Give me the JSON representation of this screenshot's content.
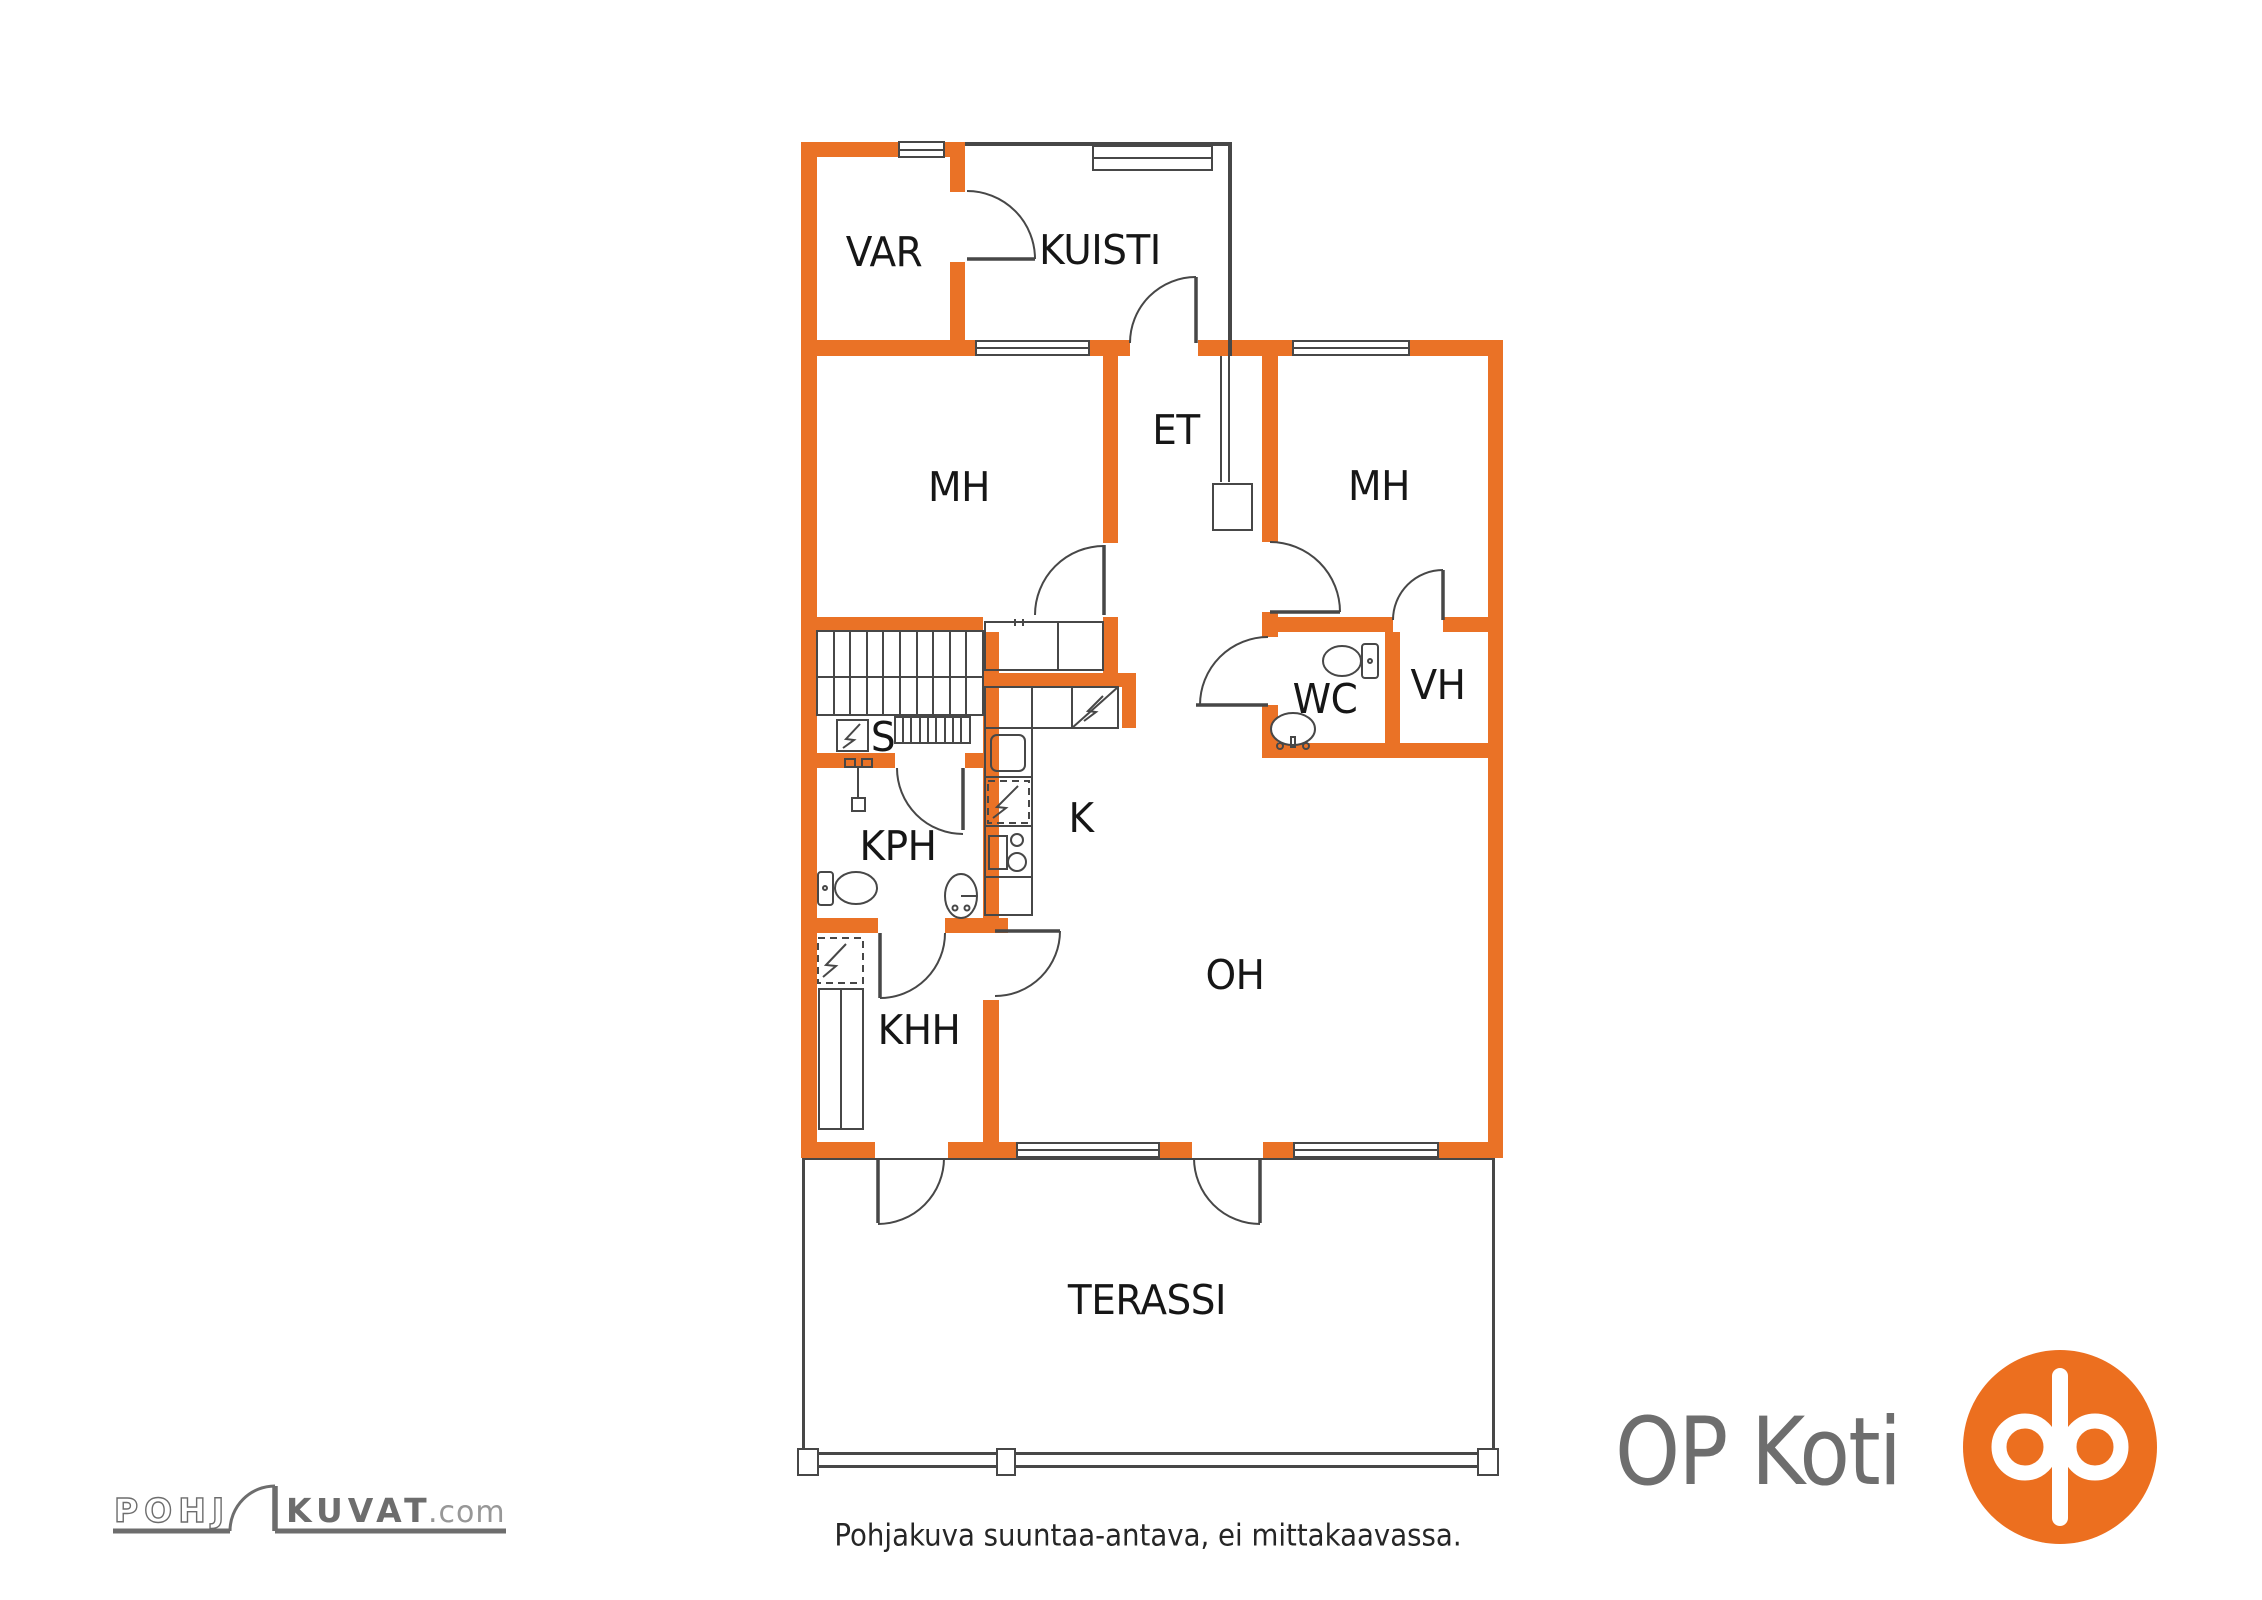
{
  "plan": {
    "wall_color": "#EA7226",
    "line_color": "#474747",
    "label_color": "#161616",
    "rooms": [
      {
        "id": "var",
        "label": "VAR"
      },
      {
        "id": "kuisti",
        "label": "KUISTI"
      },
      {
        "id": "mh-left",
        "label": "MH"
      },
      {
        "id": "et",
        "label": "ET"
      },
      {
        "id": "mh-right",
        "label": "MH"
      },
      {
        "id": "wc",
        "label": "WC"
      },
      {
        "id": "vh",
        "label": "VH"
      },
      {
        "id": "sauna",
        "label": "S"
      },
      {
        "id": "kph",
        "label": "KPH"
      },
      {
        "id": "kitchen",
        "label": "K"
      },
      {
        "id": "khh",
        "label": "KHH"
      },
      {
        "id": "oh",
        "label": "OH"
      },
      {
        "id": "terassi",
        "label": "TERASSI"
      }
    ]
  },
  "footer": {
    "disclaimer": "Pohjakuva suuntaa-antava, ei mittakaavassa."
  },
  "branding": {
    "pohjakuvat": {
      "outline_text": "POHJ",
      "solid_text": "KUVAT",
      "suffix": ".com",
      "color": "#6d6d6d"
    },
    "op_koti": {
      "wordmark": "OP Koti",
      "text_color": "#6e6e6e",
      "logo_color": "#EC6F1F"
    }
  }
}
